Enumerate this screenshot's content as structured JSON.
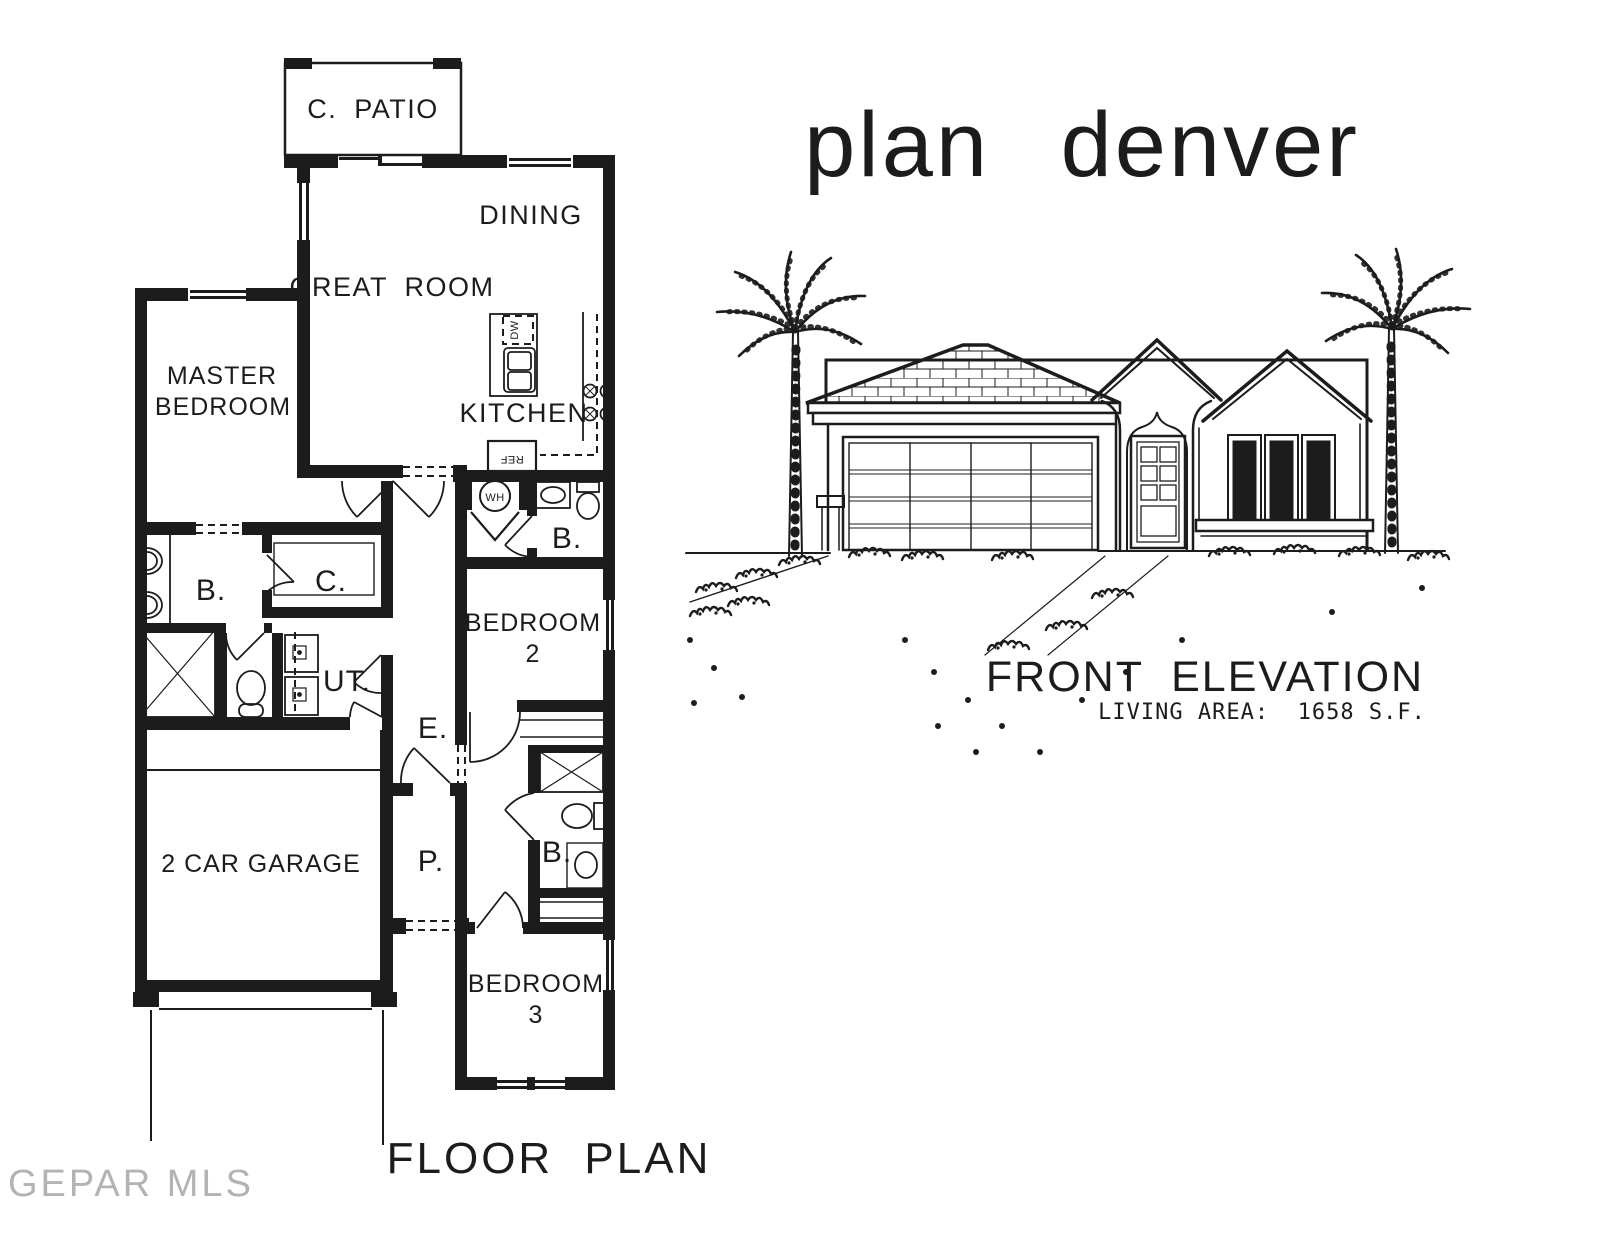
{
  "title": "plan denver",
  "floor_plan": {
    "caption": "FLOOR PLAN",
    "rooms": {
      "patio": "C. PATIO",
      "dining": "DINING",
      "great_room": "GREAT ROOM",
      "master_line1": "MASTER",
      "master_line2": "BEDROOM",
      "kitchen": "KITCHEN",
      "bath_hall": "B.",
      "bath_master": "B.",
      "closet": "C.",
      "utility": "UT.",
      "entry": "E.",
      "porch": "P.",
      "bedroom2_line1": "BEDROOM",
      "bedroom2_line2": "2",
      "bath2": "B.",
      "bedroom3_line1": "BEDROOM",
      "bedroom3_line2": "3",
      "garage": "2 CAR GARAGE"
    },
    "appliances": {
      "water_heater": "WH",
      "dishwasher": "DW",
      "refrigerator": "REF"
    }
  },
  "elevation": {
    "caption": "FRONT ELEVATION",
    "living_area": "LIVING AREA:  1658 S.F."
  },
  "watermark": "GEPAR MLS",
  "colors": {
    "ink": "#1c1c1c",
    "paper": "#ffffff",
    "watermark": "#b3b3b6"
  }
}
